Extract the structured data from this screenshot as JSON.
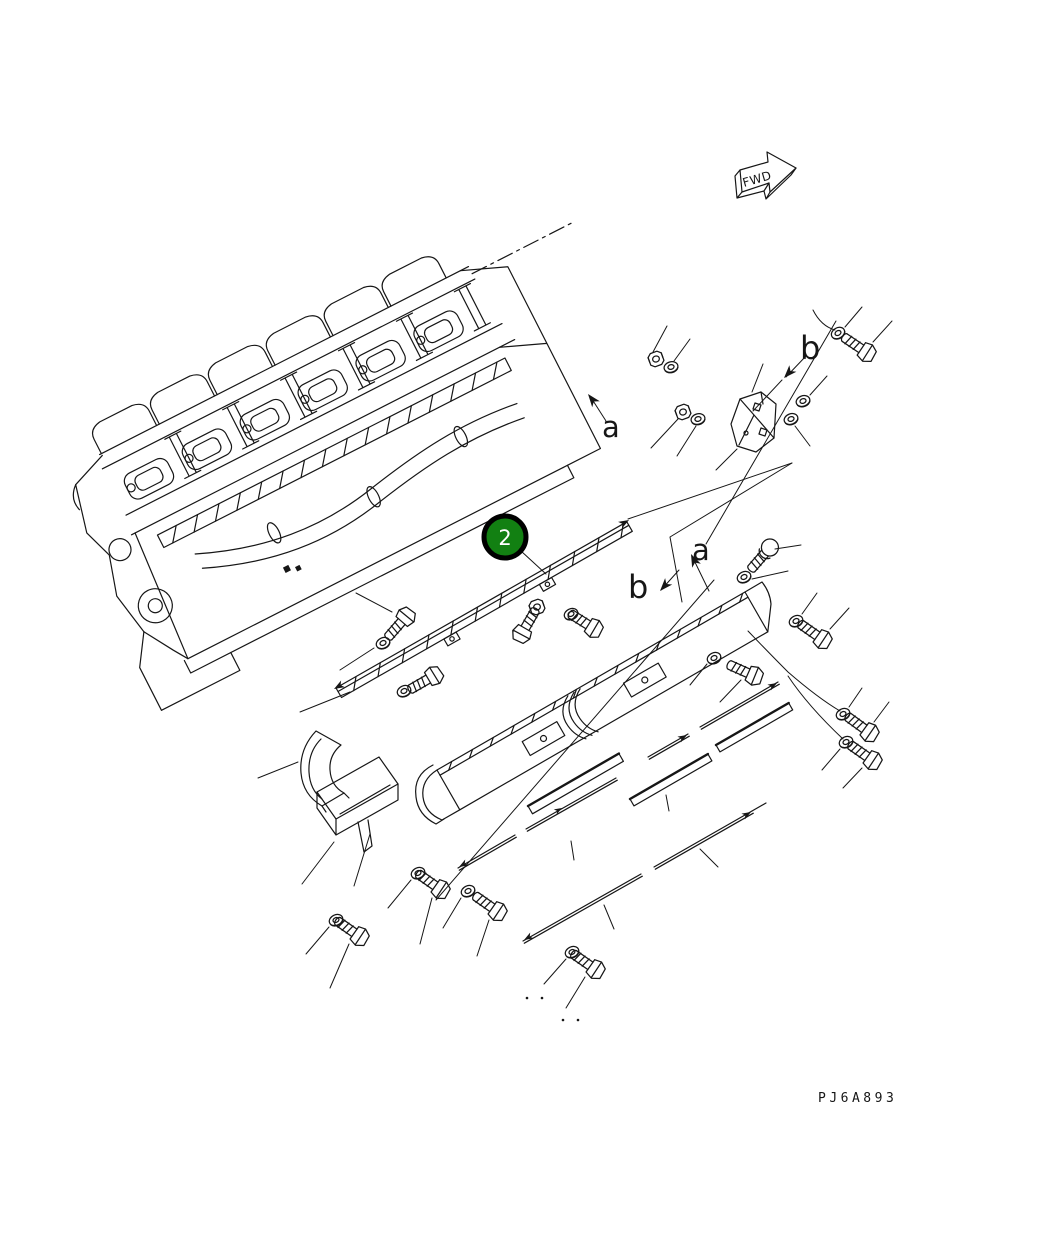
{
  "figure": {
    "title": "exploded engine cover parts diagram",
    "part_code": "PJ6A893",
    "fwd_label": "FWD",
    "callout": {
      "number": "2",
      "fill": "#128012",
      "ring": "#000000",
      "text_color": "#ffffff"
    },
    "labels": {
      "a_top": "a",
      "b_top": "b",
      "a_mid": "a",
      "b_mid": "b"
    },
    "colors": {
      "line": "#161616",
      "background": "#ffffff"
    }
  }
}
